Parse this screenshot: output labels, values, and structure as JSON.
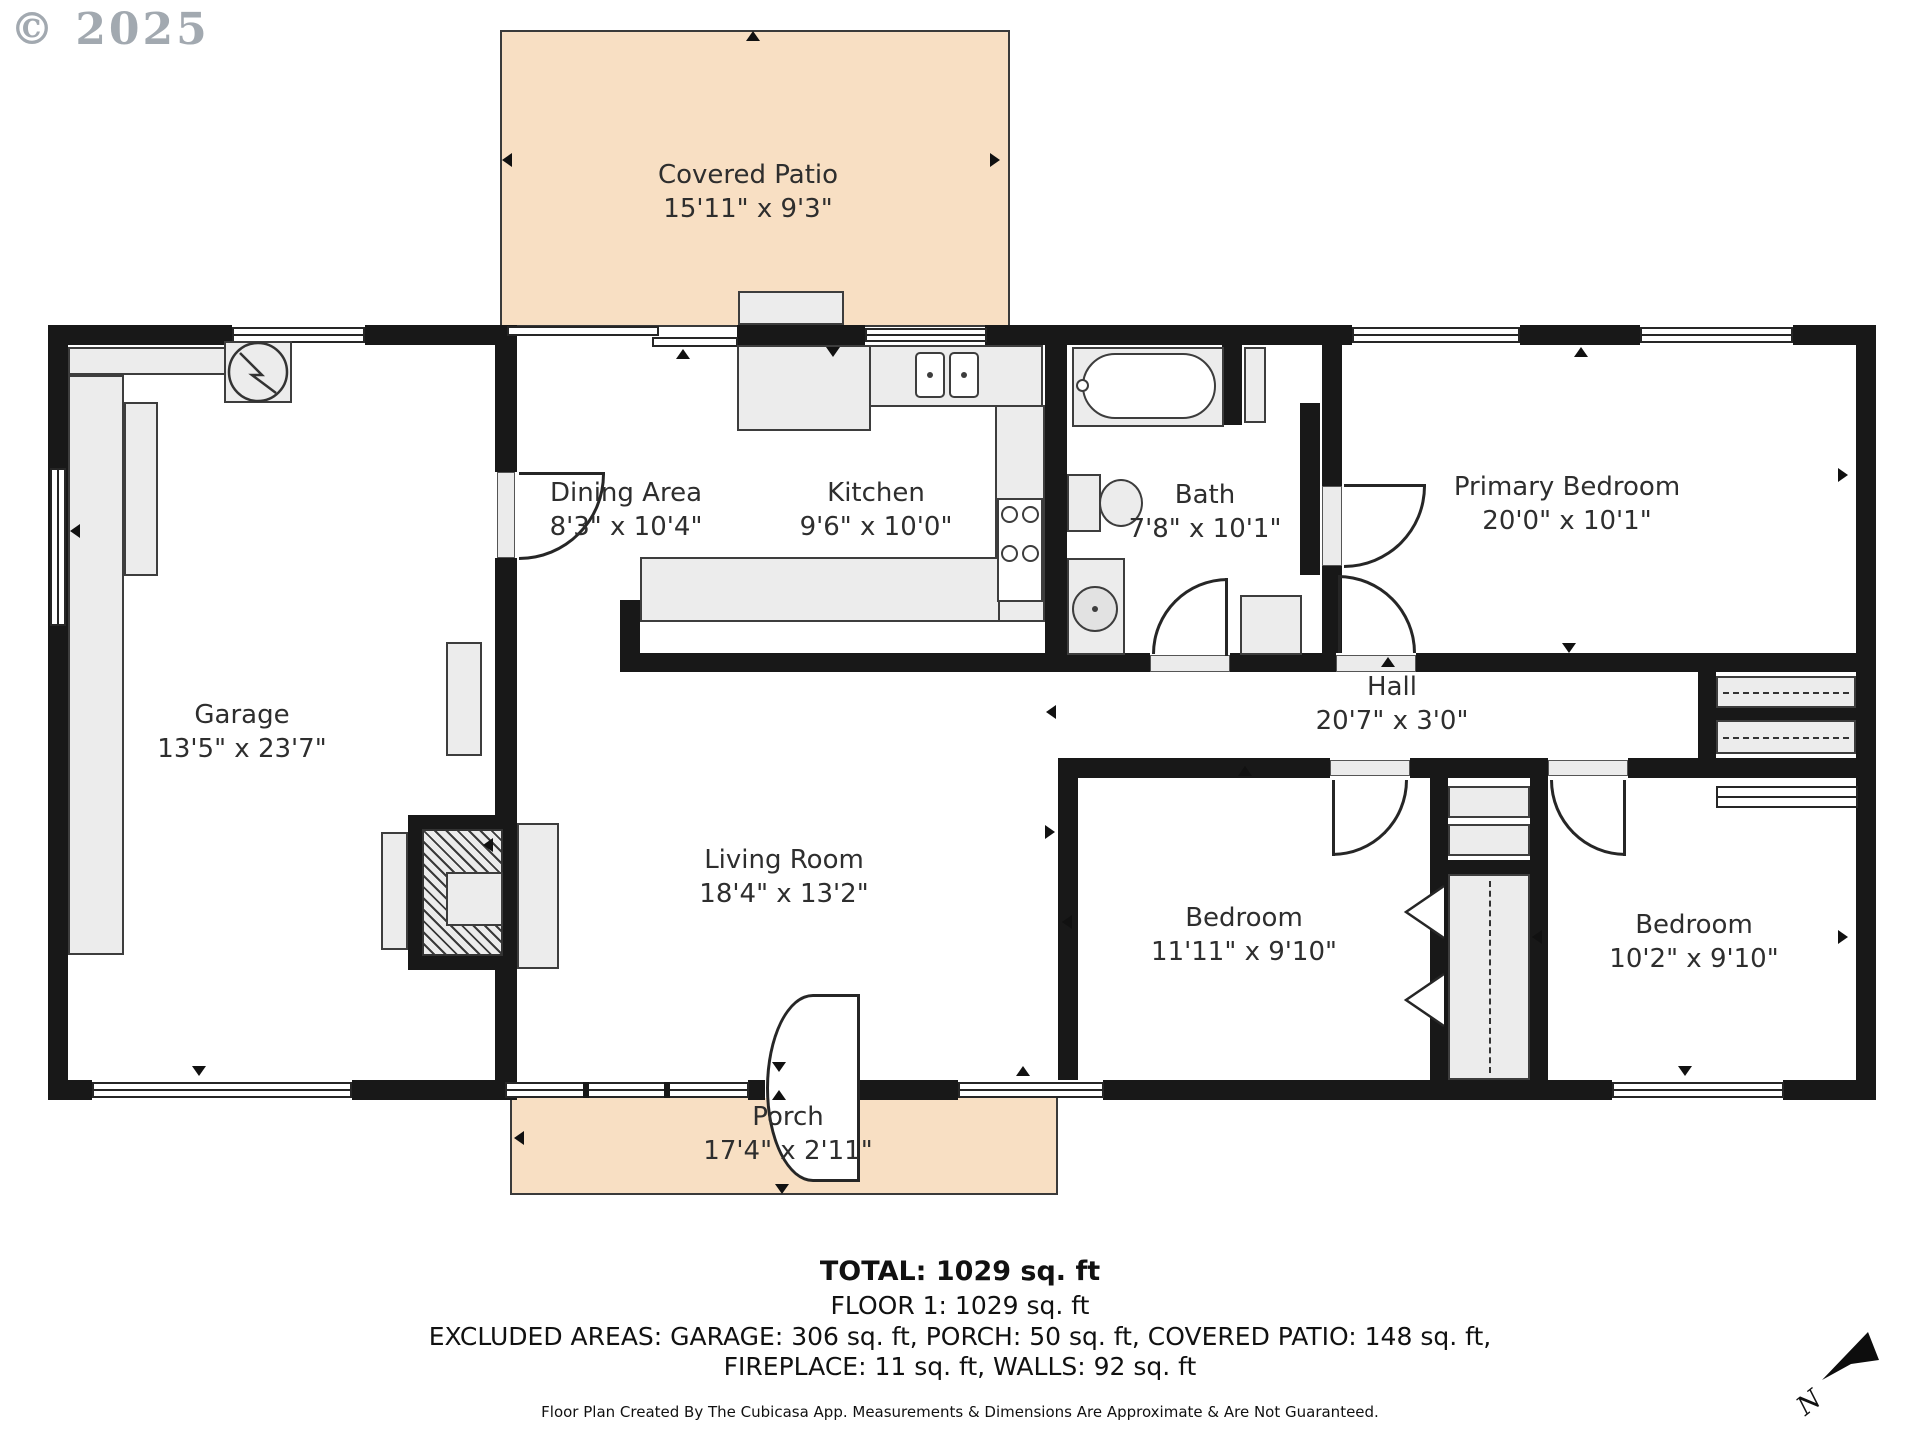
{
  "watermark": "© 2025",
  "rooms": [
    {
      "name": "Covered Patio",
      "dims": "15'11\" x 9'3\""
    },
    {
      "name": "Garage",
      "dims": "13'5\" x 23'7\""
    },
    {
      "name": "Dining Area",
      "dims": "8'3\" x 10'4\""
    },
    {
      "name": "Kitchen",
      "dims": "9'6\" x 10'0\""
    },
    {
      "name": "Bath",
      "dims": "7'8\" x 10'1\""
    },
    {
      "name": "Primary Bedroom",
      "dims": "20'0\" x 10'1\""
    },
    {
      "name": "Hall",
      "dims": "20'7\" x 3'0\""
    },
    {
      "name": "Living Room",
      "dims": "18'4\" x 13'2\""
    },
    {
      "name": "Bedroom",
      "dims": "11'11\" x 9'10\""
    },
    {
      "name": "Bedroom",
      "dims": "10'2\" x 9'10\""
    },
    {
      "name": "Porch",
      "dims": "17'4\" x 2'11\""
    }
  ],
  "summary": {
    "total": "TOTAL: 1029 sq. ft",
    "floor": "FLOOR 1: 1029 sq. ft",
    "excluded_line1": "EXCLUDED AREAS: GARAGE: 306 sq. ft, PORCH: 50 sq. ft, COVERED PATIO: 148 sq. ft,",
    "excluded_line2": "FIREPLACE: 11 sq. ft, WALLS: 92 sq. ft",
    "disclaimer": "Floor Plan Created By The Cubicasa App. Measurements & Dimensions Are Approximate & Are Not Guaranteed."
  },
  "compass": {
    "label": "N"
  },
  "colors": {
    "patio": "#f8dfc3",
    "wall": "#181818",
    "fixture": "#ececec"
  }
}
